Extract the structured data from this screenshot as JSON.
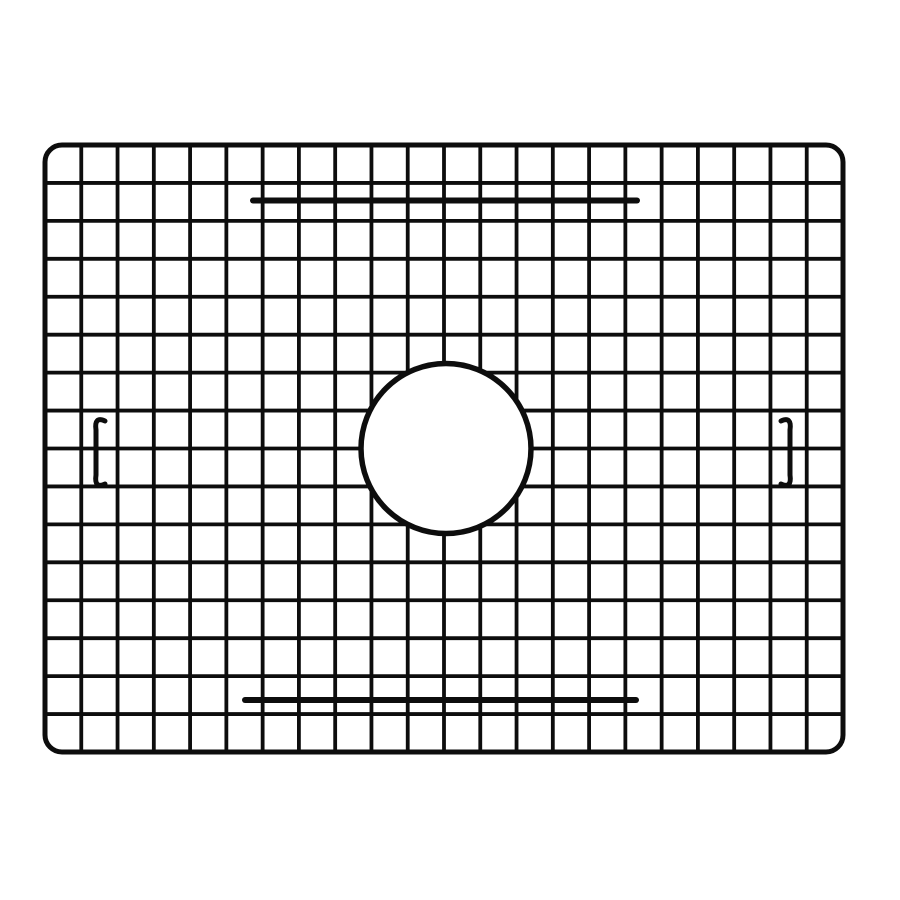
{
  "image": {
    "subject": "black wire sink bottom grid with centered round drain opening"
  },
  "palette": {
    "background_color": "#ffffff",
    "wire_color": "#0d0d0d"
  },
  "canvas": {
    "width": 900,
    "height": 900
  },
  "frame": {
    "x": 45,
    "y": 145,
    "width": 798,
    "height": 607,
    "corner_radius": 17,
    "stroke_width": 5
  },
  "mesh": {
    "columns": 22,
    "rows": 16,
    "wire_width": 3.8
  },
  "drain_opening": {
    "cx": 446,
    "cy": 448.5,
    "radius": 85,
    "stroke_width": 5.5
  },
  "bumper_bars": [
    {
      "id": "bumper-bar-top",
      "x1": 253,
      "x2": 637,
      "y": 200.5,
      "stroke_width": 6
    },
    {
      "id": "bumper-bar-bottom",
      "x1": 245,
      "x2": 636,
      "y": 700,
      "stroke_width": 6
    }
  ],
  "side_feet": [
    {
      "id": "side-foot-left",
      "x": 96,
      "y_top": 423,
      "y_bottom": 482,
      "hook_length": 9,
      "direction": 1,
      "stroke_width": 5
    },
    {
      "id": "side-foot-right",
      "x": 790,
      "y_top": 423,
      "y_bottom": 482,
      "hook_length": 9,
      "direction": -1,
      "stroke_width": 5
    }
  ]
}
